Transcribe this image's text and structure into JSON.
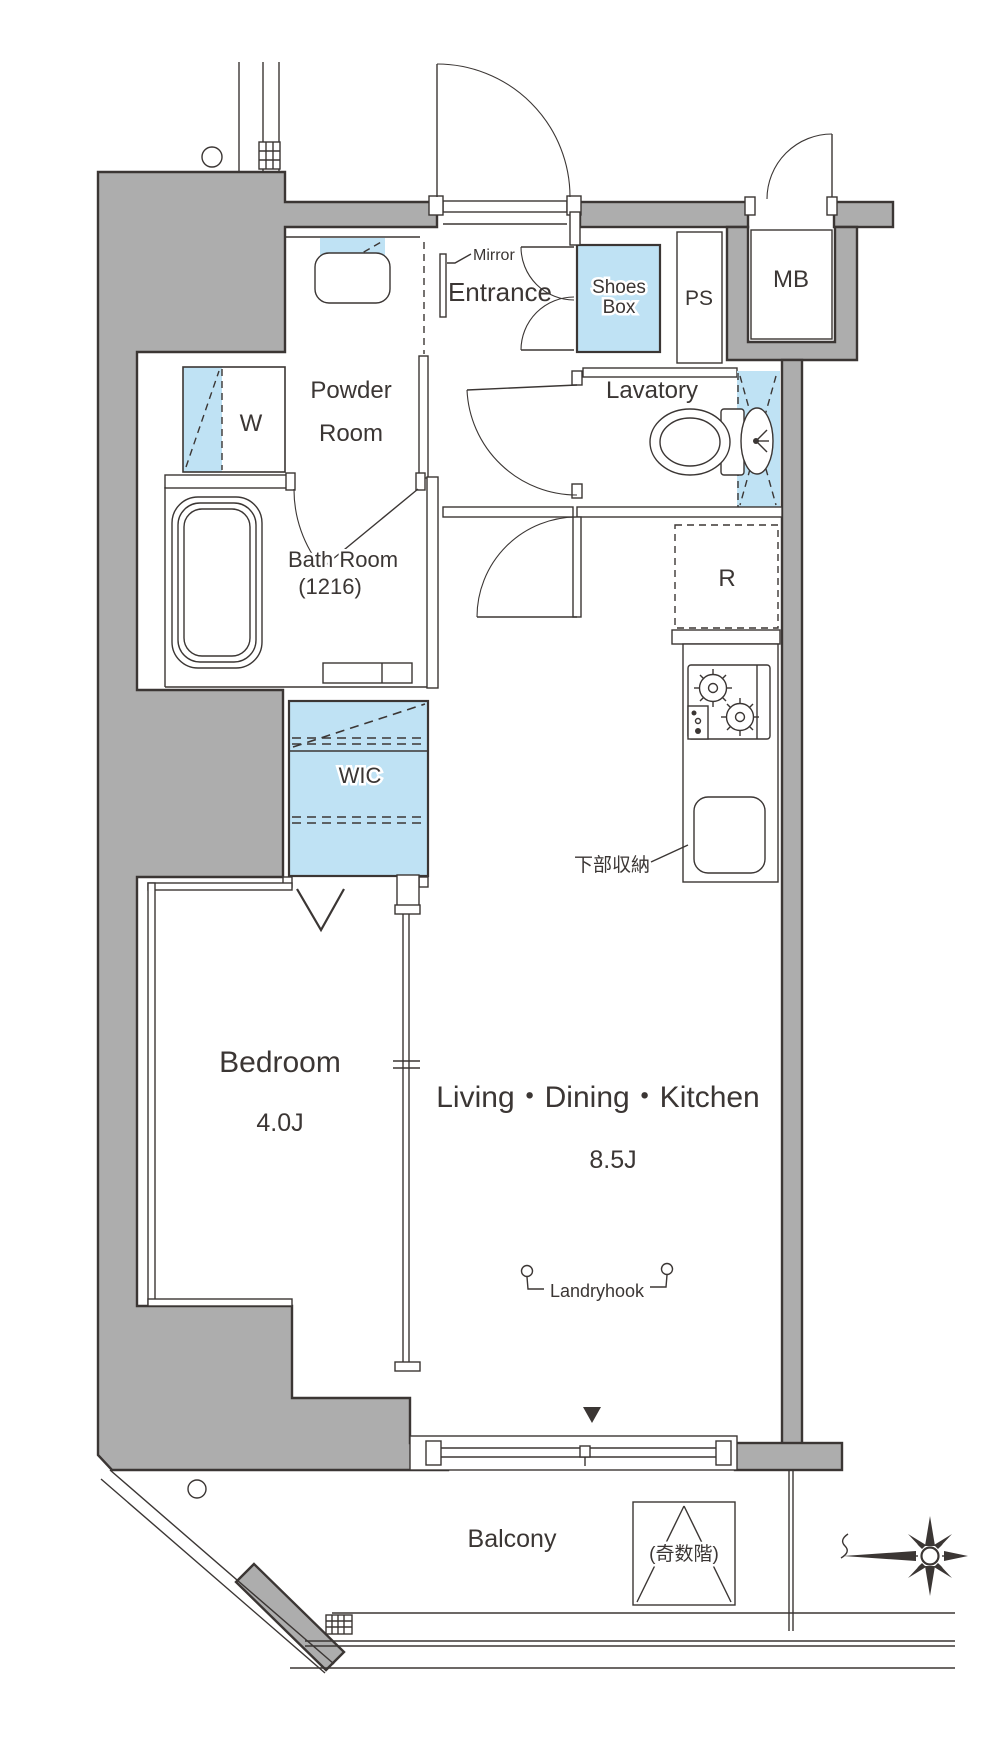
{
  "title": "apartment-floor-plan",
  "colors": {
    "wall_gray": "#adadad",
    "fixture_blue": "#bfe2f4",
    "line_ink": "#3b3634",
    "background": "#ffffff"
  },
  "rooms": {
    "entrance": {
      "label": "Entrance"
    },
    "shoes_box": {
      "line1": "Shoes",
      "line2": "Box"
    },
    "ps": {
      "label": "PS"
    },
    "mb": {
      "label": "MB"
    },
    "powder_room": {
      "line1": "Powder",
      "line2": "Room"
    },
    "washer": {
      "label": "W"
    },
    "lavatory": {
      "label": "Lavatory"
    },
    "bath_room": {
      "line1": "Bath Room",
      "line2": "(1216)"
    },
    "wic": {
      "label": "WIC"
    },
    "refrigerator": {
      "label": "R"
    },
    "bedroom": {
      "label": "Bedroom",
      "size": "4.0J"
    },
    "ldk": {
      "label": "Living・Dining・Kitchen",
      "size": "8.5J"
    },
    "balcony": {
      "label": "Balcony"
    }
  },
  "annotations": {
    "mirror": "Mirror",
    "landryhook": "Landryhook",
    "lower_storage": "下部収納",
    "odd_floors": "(奇数階)"
  }
}
